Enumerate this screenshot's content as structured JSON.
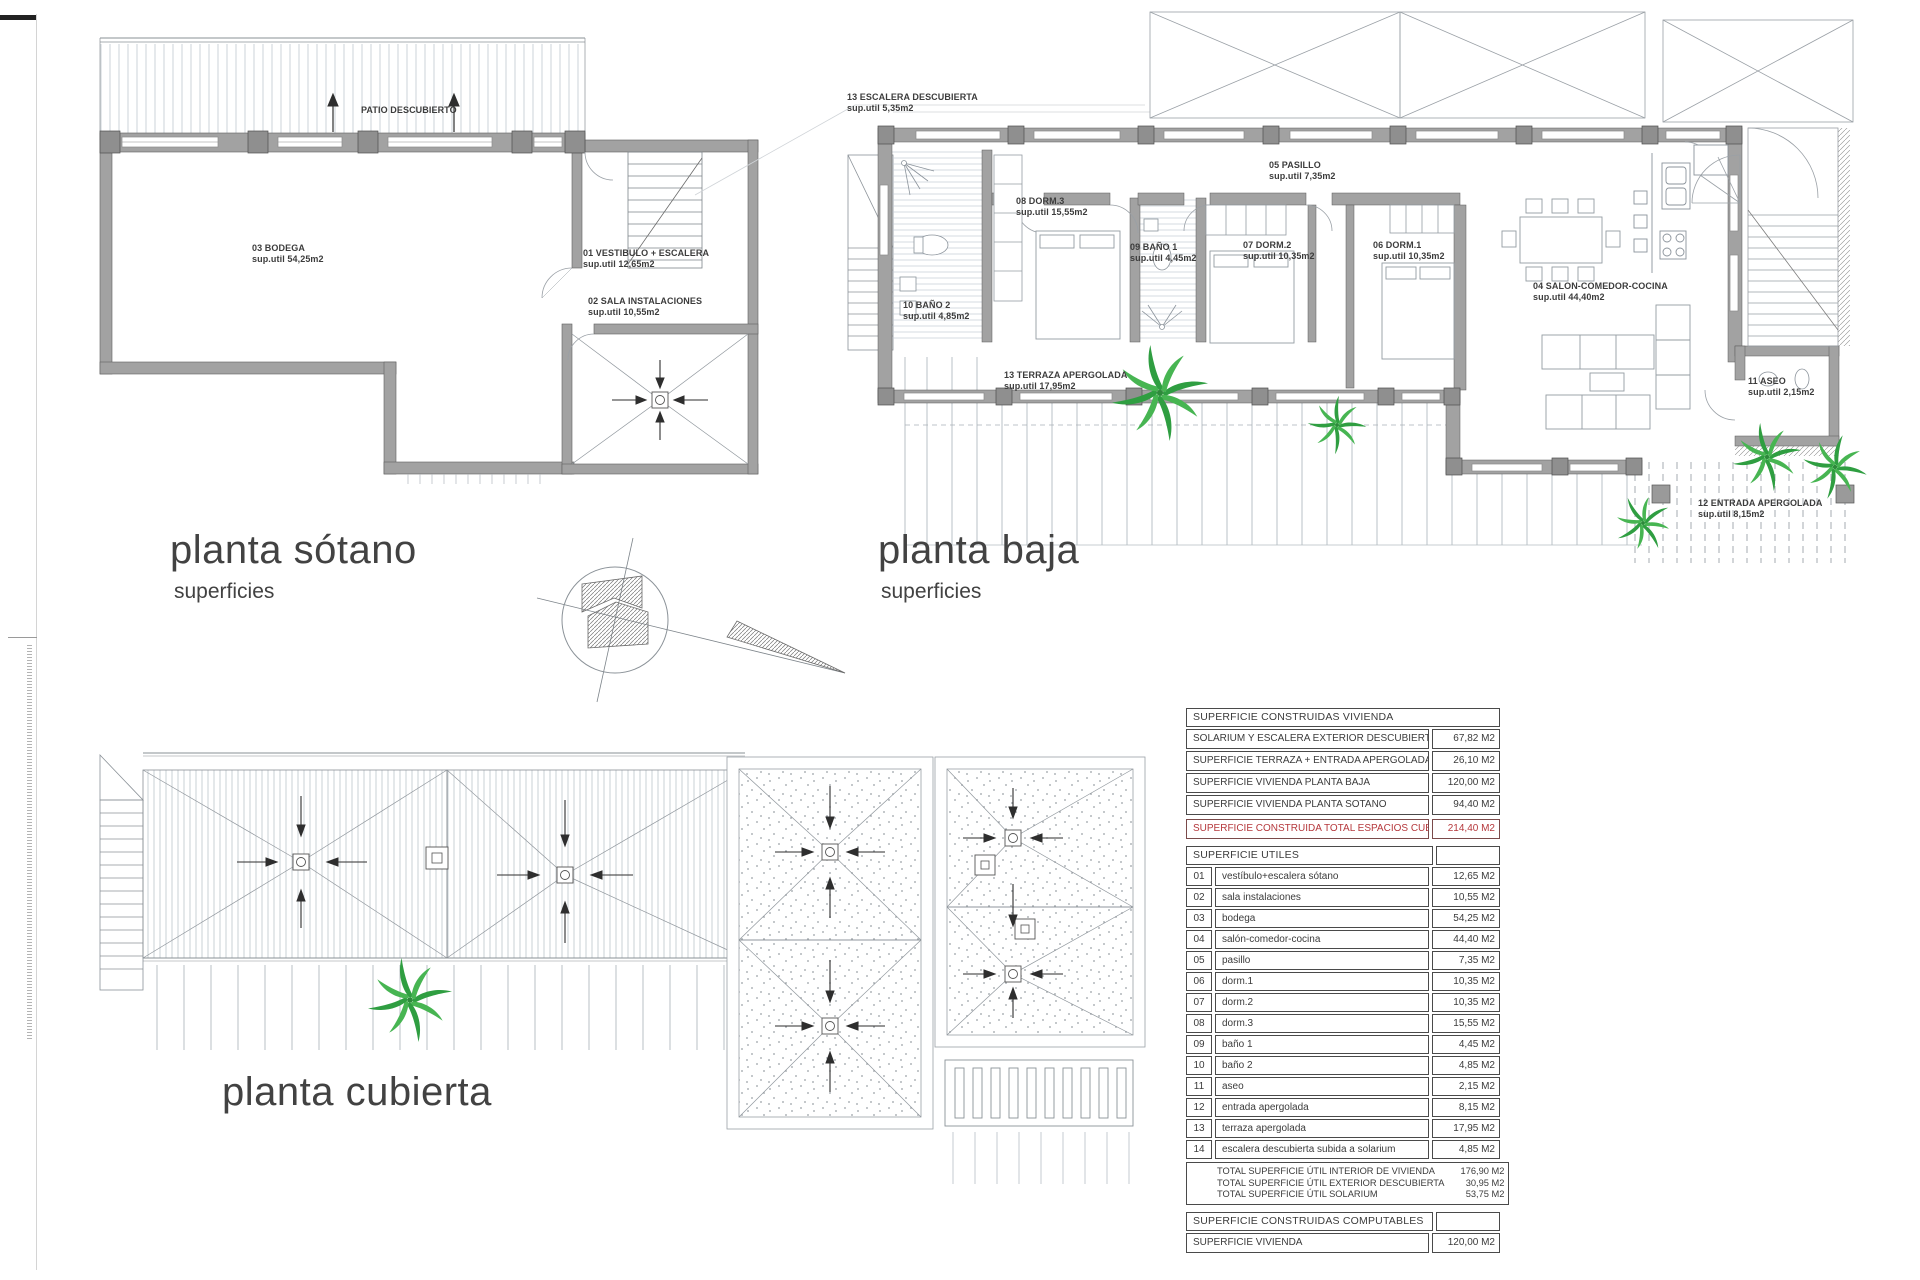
{
  "colors": {
    "accent_red": "#b5383c",
    "palm_green": "#3aa94c",
    "wall_gray": "#a0a0a0",
    "line_gray": "#8a9096",
    "text": "#3b3b3b"
  },
  "plans": {
    "sotano": {
      "title": "planta sótano",
      "subtitle": "superficies",
      "patio_label": "PATIO DESCUBIERTO",
      "rooms": [
        {
          "label": "03 BODEGA",
          "sup": "sup.util 54,25m2"
        },
        {
          "label": "01 VESTIBULO + ESCALERA",
          "sup": "sup.util 12,65m2"
        },
        {
          "label": "02 SALA INSTALACIONES",
          "sup": "sup.util 10,55m2"
        }
      ]
    },
    "baja": {
      "title": "planta baja",
      "subtitle": "superficies",
      "rooms": [
        {
          "label": "13 ESCALERA DESCUBIERTA",
          "sup": "sup.util 5,35m2"
        },
        {
          "label": "10 BAÑO 2",
          "sup": "sup.util 4,85m2"
        },
        {
          "label": "08 DORM.3",
          "sup": "sup.util 15,55m2"
        },
        {
          "label": "09 BAÑO 1",
          "sup": "sup.util 4,45m2"
        },
        {
          "label": "07 DORM.2",
          "sup": "sup.util 10,35m2"
        },
        {
          "label": "05 PASILLO",
          "sup": "sup.util 7,35m2"
        },
        {
          "label": "06 DORM.1",
          "sup": "sup.util 10,35m2"
        },
        {
          "label": "04 SALON-COMEDOR-COCINA",
          "sup": "sup.util 44,40m2"
        },
        {
          "label": "11 ASEO",
          "sup": "sup.util 2,15m2"
        },
        {
          "label": "13 TERRAZA APERGOLADA",
          "sup": "sup.util 17,95m2"
        },
        {
          "label": "12 ENTRADA APERGOLADA",
          "sup": "sup.util 8,15m2"
        }
      ]
    },
    "cubierta": {
      "title": "planta cubierta"
    }
  },
  "tables": {
    "construidas": {
      "header": "SUPERFICIE CONSTRUIDAS VIVIENDA",
      "rows": [
        {
          "label": "SOLARIUM Y ESCALERA EXTERIOR DESCUBIERTA",
          "value": "67,82 M2"
        },
        {
          "label": "SUPERFICIE TERRAZA + ENTRADA APERGOLADA",
          "value": "26,10 M2"
        },
        {
          "label": "SUPERFICIE VIVIENDA PLANTA BAJA",
          "value": "120,00 M2"
        },
        {
          "label": "SUPERFICIE VIVIENDA PLANTA SOTANO",
          "value": "94,40 M2"
        }
      ],
      "total": {
        "label": "SUPERFICIE CONSTRUIDA TOTAL ESPACIOS CUBIERTOS",
        "value": "214,40 M2"
      }
    },
    "utiles": {
      "header": "SUPERFICIE UTILES",
      "rows": [
        {
          "num": "01",
          "label": "vestíbulo+escalera sótano",
          "value": "12,65 M2"
        },
        {
          "num": "02",
          "label": "sala instalaciones",
          "value": "10,55 M2"
        },
        {
          "num": "03",
          "label": "bodega",
          "value": "54,25 M2"
        },
        {
          "num": "04",
          "label": "salón-comedor-cocina",
          "value": "44,40 M2"
        },
        {
          "num": "05",
          "label": "pasillo",
          "value": "7,35 M2"
        },
        {
          "num": "06",
          "label": "dorm.1",
          "value": "10,35 M2"
        },
        {
          "num": "07",
          "label": "dorm.2",
          "value": "10,35 M2"
        },
        {
          "num": "08",
          "label": "dorm.3",
          "value": "15,55 M2"
        },
        {
          "num": "09",
          "label": "baño 1",
          "value": "4,45 M2"
        },
        {
          "num": "10",
          "label": "baño 2",
          "value": "4,85 M2"
        },
        {
          "num": "11",
          "label": "aseo",
          "value": "2,15 M2"
        },
        {
          "num": "12",
          "label": "entrada apergolada",
          "value": "8,15 M2"
        },
        {
          "num": "13",
          "label": "terraza apergolada",
          "value": "17,95 M2"
        },
        {
          "num": "14",
          "label": "escalera descubierta subida a solarium",
          "value": "4,85 M2"
        }
      ],
      "totals": [
        {
          "label": "TOTAL SUPERFICIE ÚTIL INTERIOR DE VIVIENDA",
          "value": "176,90 M2"
        },
        {
          "label": "TOTAL SUPERFICIE ÚTIL EXTERIOR DESCUBIERTA",
          "value": "30,95 M2"
        },
        {
          "label": "TOTAL SUPERFICIE ÚTIL SOLARIUM",
          "value": "53,75 M2"
        }
      ]
    },
    "computables": {
      "header": "SUPERFICIE CONSTRUIDAS COMPUTABLES",
      "rows": [
        {
          "label": "SUPERFICIE VIVIENDA",
          "value": "120,00 M2"
        }
      ]
    }
  }
}
